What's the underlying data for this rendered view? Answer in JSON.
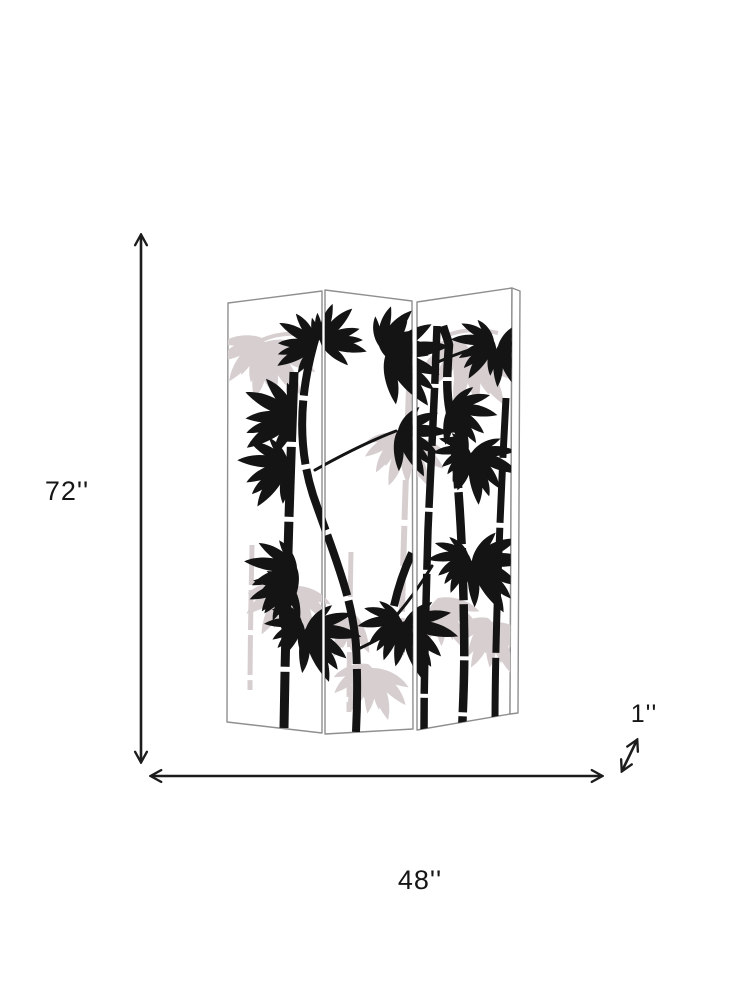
{
  "page": {
    "background_color": "#ffffff"
  },
  "diagram": {
    "type": "product-dimensions",
    "product": "three-panel folding screen with bamboo artwork",
    "dimensions": {
      "height_label": "72''",
      "width_label": "48''",
      "depth_label": "1''"
    },
    "colors": {
      "dimension_line": "#1c1c1c",
      "label_text": "#161616",
      "panel_border": "#8f8f8f",
      "panel_fill": "#ffffff",
      "bamboo_black": "#141414",
      "bamboo_gray": "#d7cfcf"
    },
    "screen": {
      "panel_count": 3,
      "artwork": "black bamboo stalks and leaves with pale gray background leaves"
    }
  }
}
